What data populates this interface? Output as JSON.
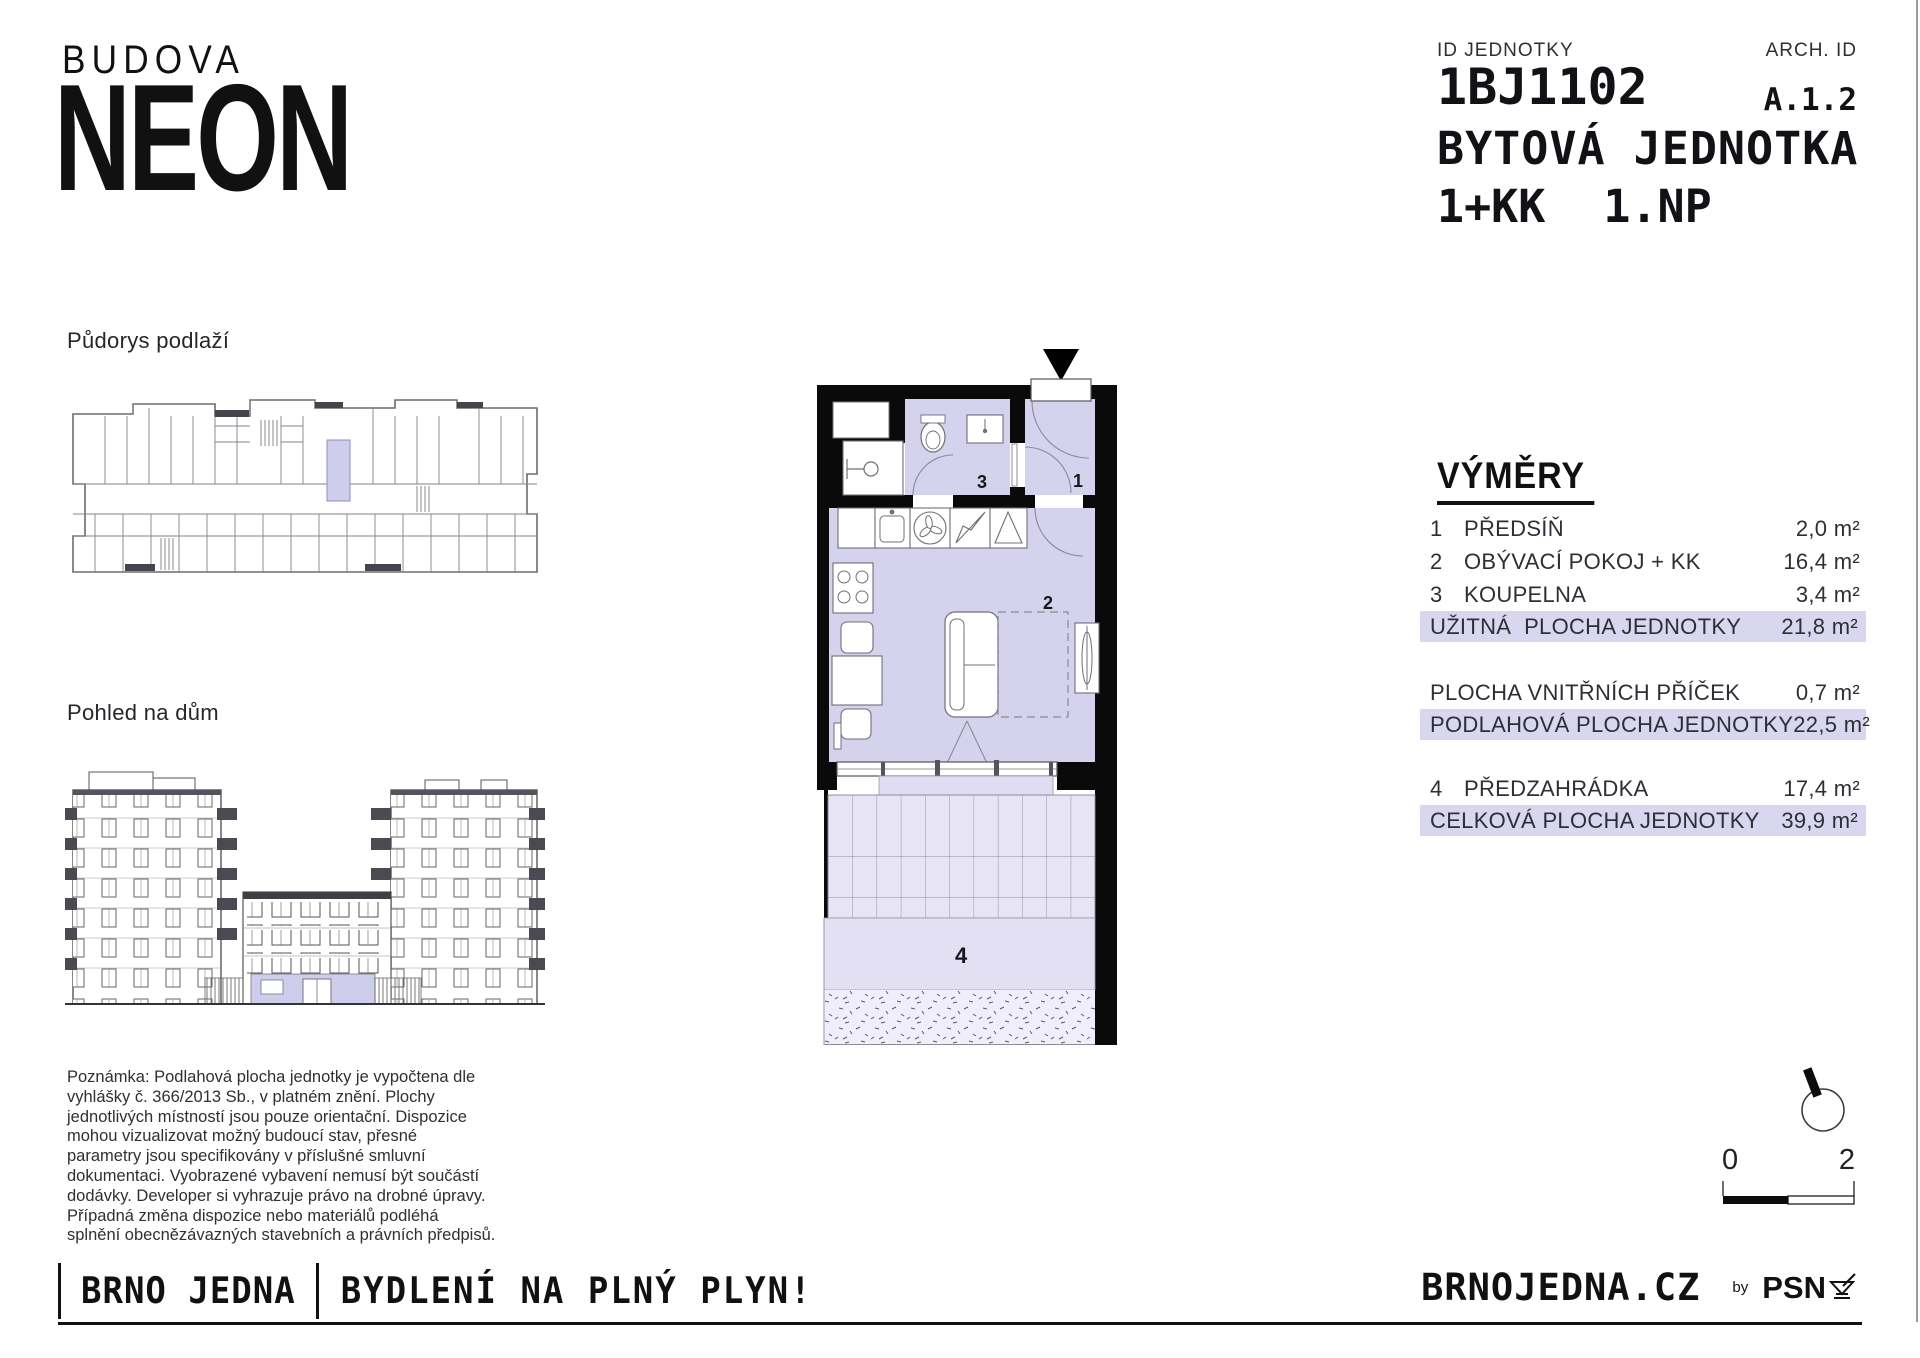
{
  "header": {
    "budova": "BUDOVA",
    "neon": "NEON",
    "id_label": "ID JEDNOTKY",
    "id_value": "1BJ1102",
    "arch_label": "ARCH. ID",
    "arch_value": "A.1.2",
    "unit_label": "BYTOVÁ JEDNOTKA",
    "layout": "1+KK",
    "floor": "1.NP"
  },
  "sections": {
    "floorplan_label": "Půdorys podlaží",
    "elevation_label": "Pohled na dům"
  },
  "plan": {
    "rooms": {
      "hall": "1",
      "living": "2",
      "bath": "3",
      "garden": "4"
    }
  },
  "table": {
    "title": "VÝMĚRY",
    "rows": [
      {
        "num": "1",
        "label": "PŘEDSÍŇ",
        "value": "2,0 m²",
        "highlight": false
      },
      {
        "num": "2",
        "label": "OBÝVACÍ POKOJ + KK",
        "value": "16,4 m²",
        "highlight": false
      },
      {
        "num": "3",
        "label": "KOUPELNA",
        "value": "3,4 m²",
        "highlight": false
      },
      {
        "num": "",
        "label": "UŽITNÁ  PLOCHA JEDNOTKY",
        "value": "21,8 m²",
        "highlight": true
      },
      {
        "num": "",
        "label": "PLOCHA VNITŘNÍCH PŘÍČEK",
        "value": "0,7 m²",
        "highlight": false
      },
      {
        "num": "",
        "label": "PODLAHOVÁ PLOCHA JEDNOTKY",
        "value": "22,5 m²",
        "highlight": true
      },
      {
        "num": "4",
        "label": "PŘEDZAHRÁDKA",
        "value": "17,4 m²",
        "highlight": false
      },
      {
        "num": "",
        "label": "CELKOVÁ PLOCHA JEDNOTKY",
        "value": "39,9 m²",
        "highlight": true
      }
    ]
  },
  "note": {
    "text": "Poznámka: Podlahová plocha jednotky je vypočtena dle\nvyhlášky č. 366/2013 Sb., v platném znění. Plochy\njednotlivých místností jsou pouze orientační. Dispozice\nmohou vizualizovat možný budoucí stav, přesné\nparametry jsou specifikovány v příslušné smluvní\ndokumentaci. Vyobrazené vybavení nemusí být součástí\ndodávky. Developer si vyhrazuje právo na drobné úpravy.\nPřípadná změna dispozice nebo materiálů podléhá\nsplnění obecnězávazných stavebních a právních předpisů."
  },
  "scale": {
    "start": "0",
    "end": "2"
  },
  "footer": {
    "brand": "BRNO JEDNA",
    "slogan": "BYDLENÍ NA PLNÝ PLYN!",
    "site": "BRNOJEDNA.CZ",
    "by": "by",
    "psn": "PSN"
  },
  "colors": {
    "room_fill": "#d4d2ed",
    "highlight_row": "#d9d6f0",
    "terrace_tile": "#e7e5f5",
    "garden_strip": "#e2e0f2",
    "ink": "#111111"
  }
}
